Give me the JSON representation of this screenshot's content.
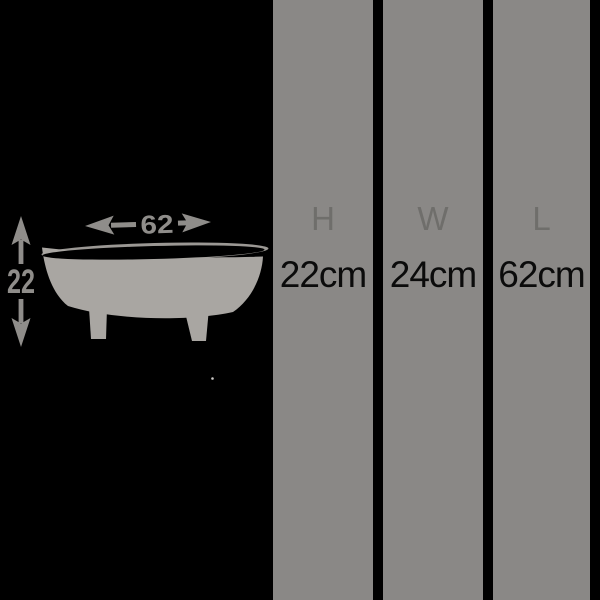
{
  "canvas": {
    "background_color": "#000000"
  },
  "illustration": {
    "icon": "clawfoot-bathtub-icon",
    "tub_color": "#a9a6a2",
    "dimension_color": "#8f8d8a",
    "width_dimension": {
      "label": "62",
      "direction": "horizontal"
    },
    "height_dimension": {
      "label": "22",
      "direction": "vertical"
    }
  },
  "bars": {
    "background_color": "#8a8886",
    "letter_color": "#6f6e6b",
    "value_color": "#0b0b0b",
    "items": [
      {
        "letter": "H",
        "value": "22cm"
      },
      {
        "letter": "W",
        "value": "24cm"
      },
      {
        "letter": "L",
        "value": "62cm"
      }
    ]
  }
}
